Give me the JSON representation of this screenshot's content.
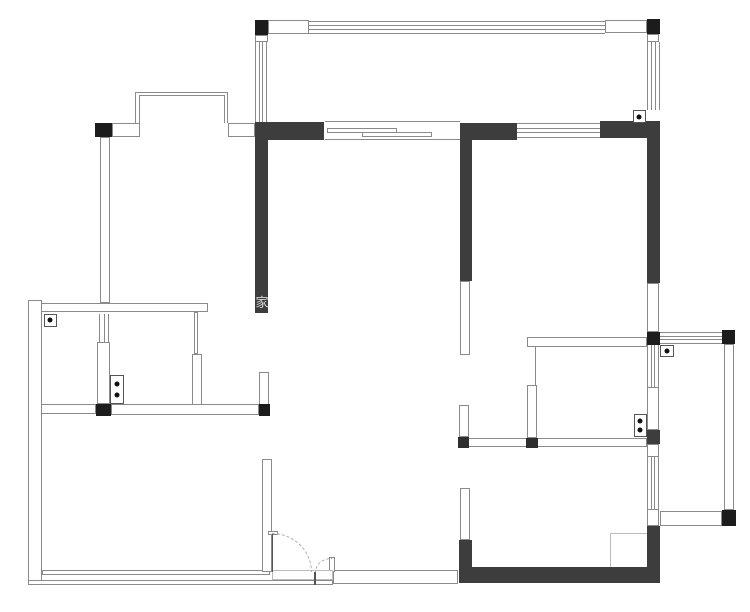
{
  "plan": {
    "type": "apartment-floor-plan",
    "canvas": {
      "width": 750,
      "height": 612
    },
    "colors": {
      "wall_fill": "#3d3d3d",
      "post_fill": "#1c1c1c",
      "dark_square_fill": "#2e2e2e",
      "line": "#8a8a8a",
      "line_light": "#bcbcbc",
      "leaf": "#555555",
      "arc": "#aaaaaa",
      "dot": "#111111",
      "background": "#ffffff"
    },
    "watermark": {
      "text": "家",
      "x": 255.5,
      "y": 292,
      "size": 13
    },
    "walls_black": [
      [
        255,
        121.5,
        68.5,
        18.5
      ],
      [
        255,
        140,
        13,
        173
      ],
      [
        459.5,
        123,
        57,
        17
      ],
      [
        459.5,
        140,
        12,
        141
      ],
      [
        600,
        120.5,
        60,
        17.5
      ],
      [
        646.5,
        138,
        13.5,
        145
      ],
      [
        646.5,
        430,
        13.5,
        13.5
      ],
      [
        458.5,
        539.5,
        13,
        43.5
      ],
      [
        458.5,
        566.5,
        201.5,
        16.5
      ],
      [
        646.5,
        526,
        13.5,
        45
      ]
    ],
    "posts": [
      [
        254.5,
        19.5,
        13,
        15.5
      ],
      [
        646.5,
        19,
        13,
        15
      ],
      [
        95,
        122.5,
        16.5,
        14
      ],
      [
        96,
        403.5,
        14.5,
        12
      ],
      [
        258.5,
        403.5,
        11.5,
        12
      ],
      [
        646.5,
        331.5,
        13.5,
        13.5
      ],
      [
        721.5,
        330,
        13.5,
        13.5
      ],
      [
        721.5,
        510,
        14.5,
        15.5
      ]
    ],
    "dark_squares": [
      [
        457.5,
        437,
        11.5,
        11
      ],
      [
        526,
        437.5,
        11.5,
        10.5
      ]
    ],
    "walls_white": [
      [
        111.5,
        122.5,
        28.5,
        14
      ],
      [
        227.5,
        122.5,
        27.5,
        14
      ],
      [
        100,
        136.5,
        10,
        166.5
      ],
      [
        28,
        302.5,
        180,
        9.5
      ],
      [
        193.5,
        312,
        4,
        41.5
      ],
      [
        191.5,
        353.5,
        10,
        51.5
      ],
      [
        96.5,
        341.5,
        13.5,
        62
      ],
      [
        41,
        403.5,
        55,
        10
      ],
      [
        110.5,
        404,
        148,
        10.5
      ],
      [
        258.5,
        371.5,
        10,
        33.5
      ],
      [
        28,
        300,
        13.5,
        284.5
      ],
      [
        41.5,
        569.5,
        228.5,
        5.5
      ],
      [
        28,
        580,
        305,
        5
      ],
      [
        262,
        459,
        10,
        113
      ],
      [
        333,
        569.5,
        125,
        14
      ],
      [
        459.5,
        281,
        10,
        74
      ],
      [
        458.5,
        405,
        10,
        32
      ],
      [
        459.5,
        488,
        10,
        51.5
      ],
      [
        526.5,
        337,
        120,
        10
      ],
      [
        526.5,
        385,
        10,
        53
      ],
      [
        457.5,
        437.5,
        189,
        9
      ],
      [
        646.5,
        283,
        12.5,
        49
      ],
      [
        646.5,
        386.5,
        12,
        43.5
      ],
      [
        646.5,
        443.5,
        12,
        13.5
      ],
      [
        646.5,
        508.5,
        12,
        17.5
      ],
      [
        723.5,
        343.5,
        10,
        166.5
      ],
      [
        660,
        510.5,
        61.5,
        15
      ],
      [
        267.5,
        20,
        41,
        14
      ],
      [
        605,
        19.5,
        42,
        13.5
      ],
      [
        255,
        35,
        12.5,
        7
      ],
      [
        647,
        34,
        12,
        7.5
      ],
      [
        328.5,
        556.5,
        6.5,
        15.5
      ],
      [
        267.5,
        531,
        10,
        4
      ],
      [
        326.5,
        128,
        70.5,
        4.5
      ],
      [
        361.5,
        132,
        70.5,
        4.5
      ]
    ],
    "rects_light": [
      [
        272,
        570,
        61,
        10
      ],
      [
        610,
        533,
        38,
        35
      ]
    ],
    "bay_window": {
      "outer": [
        135,
        91.5,
        92.5,
        31.5
      ],
      "inner": [
        138.5,
        95,
        86,
        28
      ]
    },
    "windows": [
      {
        "t": "h",
        "n": 4,
        "r": [
          308.5,
          20.5,
          296.5,
          13
        ]
      },
      {
        "t": "v",
        "n": 4,
        "r": [
          254.5,
          41.5,
          12.5,
          80.5
        ]
      },
      {
        "t": "v",
        "n": 4,
        "r": [
          647,
          41.5,
          12.5,
          68.5
        ]
      },
      {
        "t": "h",
        "n": 4,
        "r": [
          516.5,
          123,
          83.5,
          14.5
        ]
      },
      {
        "t": "v",
        "n": 3,
        "r": [
          98.5,
          313.5,
          10,
          28
        ]
      },
      {
        "t": "v",
        "n": 4,
        "r": [
          646.5,
          345,
          12,
          41.5
        ]
      },
      {
        "t": "v",
        "n": 4,
        "r": [
          646.5,
          457,
          12,
          51.5
        ]
      },
      {
        "t": "h",
        "n": 4,
        "r": [
          660,
          331.5,
          61.5,
          12
        ]
      }
    ],
    "lines": [
      [
        325,
        121.3,
        134.5,
        1.2,
        "line"
      ],
      [
        325,
        138.5,
        134.5,
        1.2,
        "line"
      ],
      [
        535,
        347,
        1,
        38,
        "line"
      ],
      [
        271.5,
        533,
        1.5,
        39,
        "leaf"
      ],
      [
        314.3,
        572,
        1.5,
        13,
        "leaf"
      ]
    ],
    "door_arcs": [
      {
        "r": [
          272,
          533,
          40,
          39
        ],
        "corner": "tr"
      },
      {
        "r": [
          315,
          558,
          16.5,
          14
        ],
        "corner": "tl"
      }
    ],
    "symbol_boxes": [
      {
        "r": [
          43.5,
          313.5,
          13,
          13
        ],
        "dots": 1
      },
      {
        "r": [
          632.5,
          110,
          13.5,
          13
        ],
        "dots": 1
      },
      {
        "r": [
          660,
          345,
          13.5,
          11.5
        ],
        "dots": 1
      },
      {
        "r": [
          110,
          375,
          13.5,
          28.5
        ],
        "dots": 2
      },
      {
        "r": [
          633.5,
          413.5,
          13,
          23.5
        ],
        "dots": 2
      }
    ]
  }
}
